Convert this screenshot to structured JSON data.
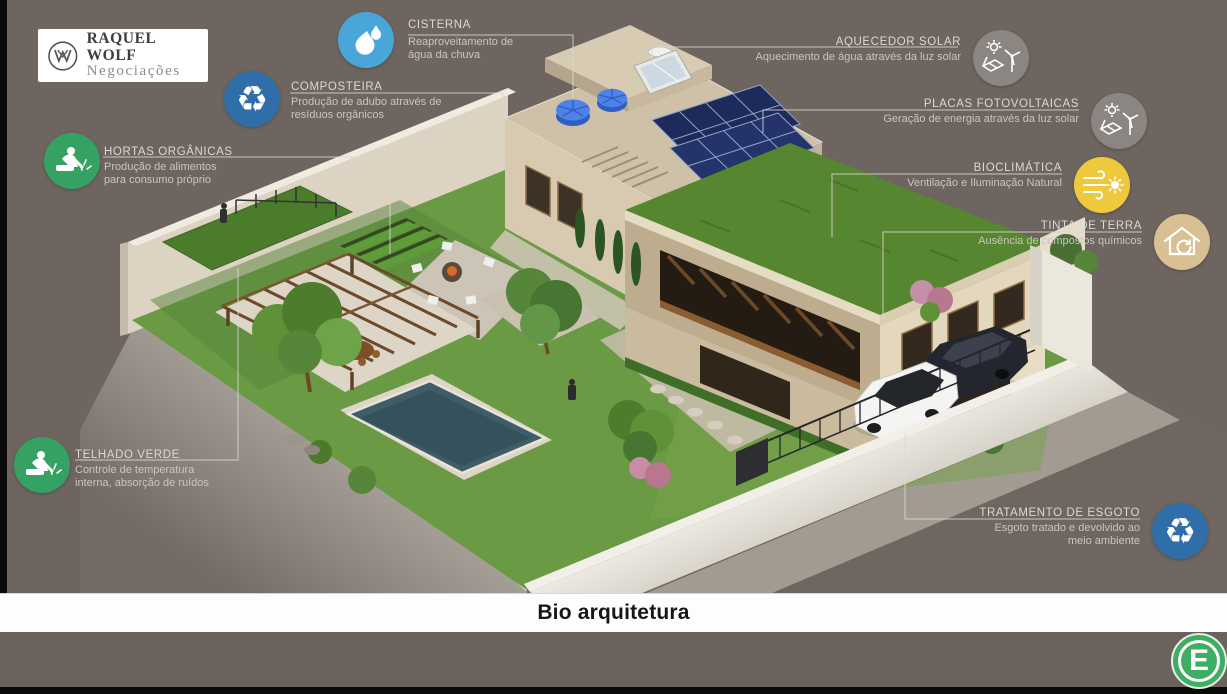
{
  "brand": {
    "name": "RAQUEL WOLF",
    "subtitle": "Negociações",
    "monogram": "rw-monogram-icon"
  },
  "slide": {
    "title": "Bio arquitetura",
    "watermark_letter": "E"
  },
  "palette": {
    "background": "#6E6560",
    "label_title": "#DCD8D3",
    "label_description": "#CAC5BF",
    "connector_line": "#DCD8D2",
    "blue_icon": "#2F6EA8",
    "light_blue_icon": "#4AA6D8",
    "green_icon": "#35A264",
    "gray_icon": "#8B8681",
    "yellow_icon": "#EFC93D",
    "tan_icon": "#D9C093",
    "footer_logo_green": "#3FAE62"
  },
  "features": [
    {
      "id": "cisterna",
      "title": "CISTERNA",
      "description": "Reaproveitamento de água da chuva",
      "icon": "water-drops-icon",
      "icon_color": "#4AA6D8",
      "side": "left"
    },
    {
      "id": "composteira",
      "title": "COMPOSTEIRA",
      "description": "Produção de adubo através de resíduos orgânicos",
      "icon": "recycle-icon",
      "icon_color": "#2F6EA8",
      "side": "left"
    },
    {
      "id": "hortas-organicas",
      "title": "HORTAS ORGÂNICAS",
      "description": "Produção de alimentos para consumo próprio",
      "icon": "gardener-icon",
      "icon_color": "#35A264",
      "side": "left"
    },
    {
      "id": "aquecedor-solar",
      "title": "AQUECEDOR SOLAR",
      "description": "Aquecimento de água através da luz solar",
      "icon": "solar-energy-icon",
      "icon_color": "#8B8681",
      "side": "right"
    },
    {
      "id": "placas-fotovoltaicas",
      "title": "PLACAS FOTOVOLTAICAS",
      "description": "Geração de energia através da luz solar",
      "icon": "solar-energy-icon",
      "icon_color": "#8B8681",
      "side": "right"
    },
    {
      "id": "bioclimatica",
      "title": "BIOCLIMÁTICA",
      "description": "Ventilação e Iluminação Natural",
      "icon": "wind-sun-icon",
      "icon_color": "#EFC93D",
      "side": "right"
    },
    {
      "id": "tinta-de-terra",
      "title": "TINTA DE TERRA",
      "description": "Ausência de compostos químicos",
      "icon": "eco-house-icon",
      "icon_color": "#D9C093",
      "side": "right"
    },
    {
      "id": "telhado-verde",
      "title": "TELHADO VERDE",
      "description": "Controle de temperatura interna, absorção de ruídos",
      "icon": "gardener-icon",
      "icon_color": "#35A264",
      "side": "left"
    },
    {
      "id": "tratamento-de-esgoto",
      "title": "TRATAMENTO DE ESGOTO",
      "description": "Esgoto tratado e devolvido ao meio ambiente",
      "icon": "recycle-icon",
      "icon_color": "#2F6EA8",
      "side": "right"
    }
  ]
}
